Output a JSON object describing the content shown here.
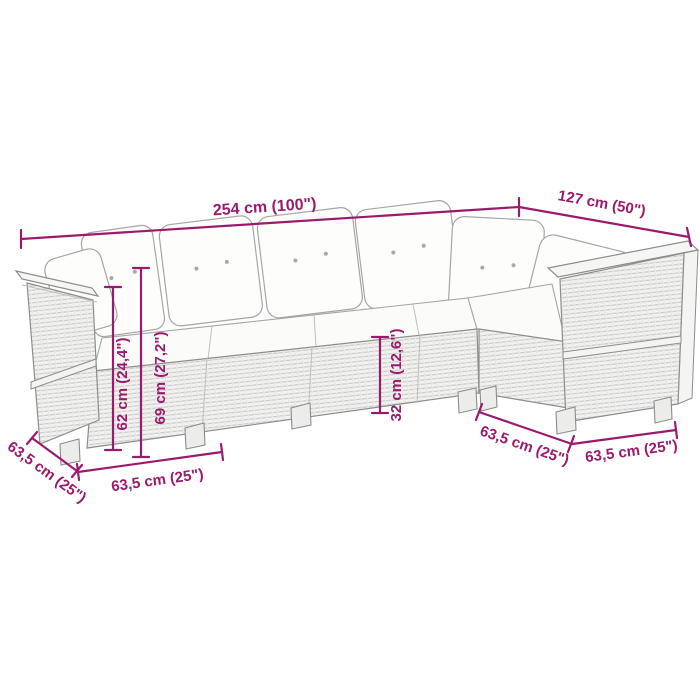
{
  "labels": {
    "length_main": "254 cm (100\")",
    "length_right": "127 cm (50\")",
    "height_seat_62": "62 cm (24,4\")",
    "height_back_69": "69 cm (27,2\")",
    "height_base_32": "32 cm (12,6\")",
    "depth_left": "63,5 cm (25\")",
    "width_left": "63,5 cm (25\")",
    "depth_right": "63,5 cm (25\")",
    "width_right": "63,5 cm (25\")"
  },
  "colors": {
    "accent": "#9B1A6C",
    "line": "#8D8D8B",
    "background": "#FFFFFF"
  }
}
